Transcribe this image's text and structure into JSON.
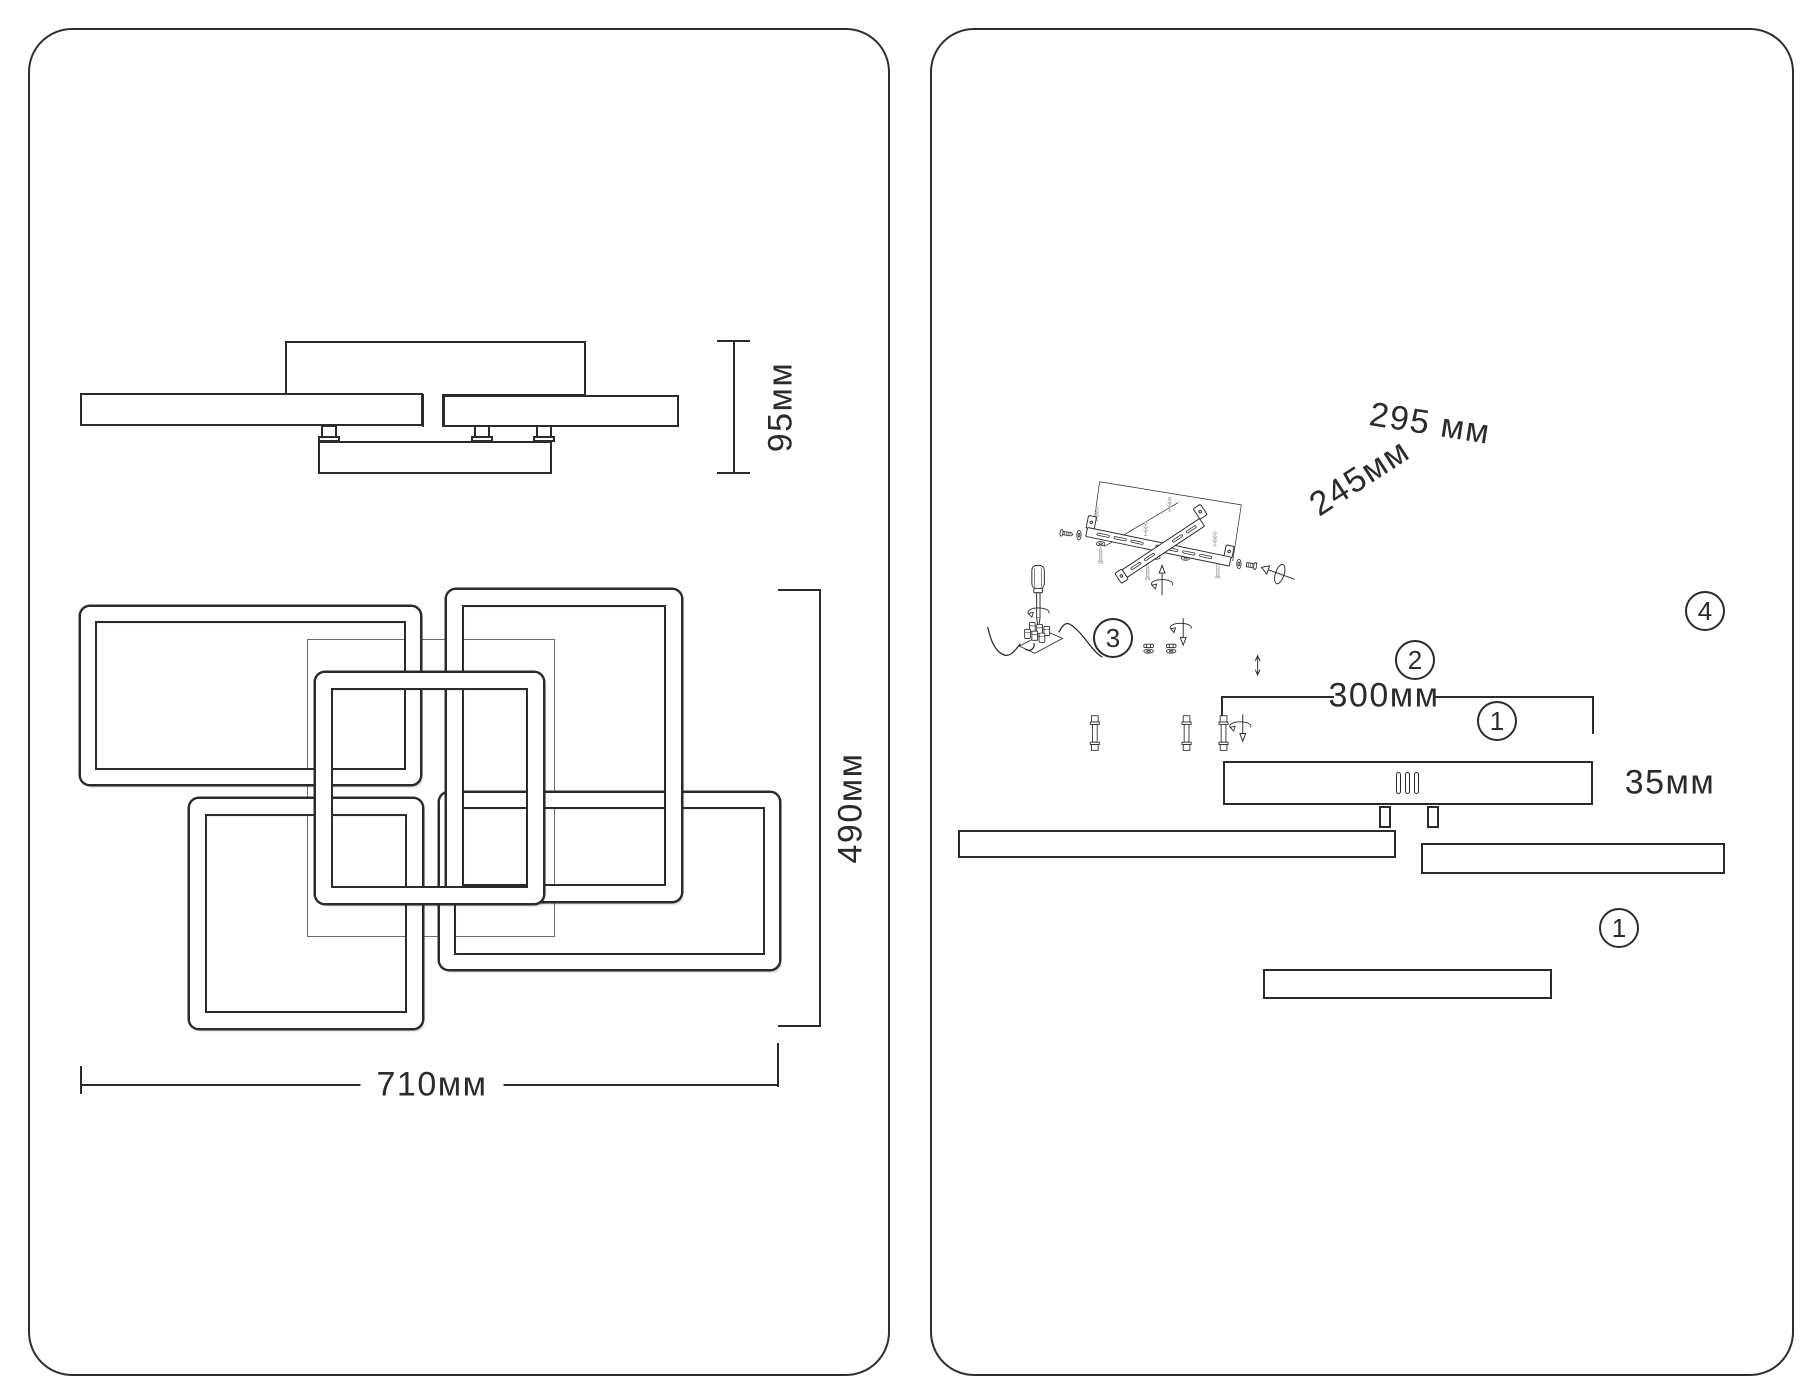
{
  "title": "Ceiling chandelier dimensions and installation diagram",
  "colors": {
    "line": "#2b2b2b",
    "hardware_light": "#b0b0b0",
    "background": "#ffffff"
  },
  "left": {
    "side_height": "95мм",
    "plan_width": "710мм",
    "plan_height": "490мм"
  },
  "right": {
    "bracket_length": "295 мм",
    "bracket_diagonal": "245мм",
    "base_width": "300мм",
    "base_height": "35мм",
    "step1": "1",
    "step2": "2",
    "step3": "3",
    "step4": "4"
  }
}
